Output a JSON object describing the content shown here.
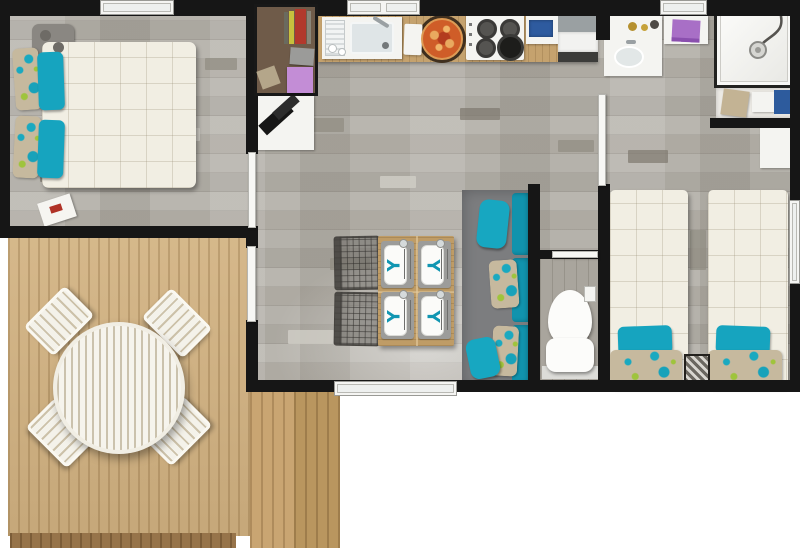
{
  "scene": {
    "description": "Top-down 3D rendered floor plan of a two-bedroom holiday mobile home with a wooden terrace",
    "background_color": "#ffffff"
  },
  "palette": {
    "wall": "#161616",
    "interior_floor": "#b5b2ab",
    "terrace_wood": "#d2b281",
    "terrace_step": "#c9a572",
    "accent_teal": "#16a4bf",
    "bedding_white": "#f1eee3",
    "sofa_gray": "#7c7d7f",
    "counter_wood": "#c5a26e",
    "towel_purple": "#a86fc6",
    "accessory_blue": "#2d5b9d",
    "pizza_orange": "#cf5d28"
  },
  "rooms": [
    {
      "id": "master-bedroom",
      "label": "Master bedroom",
      "items": [
        "double-bed",
        "teal-pillows",
        "patterned-pillows",
        "wall-lamp",
        "magazine"
      ]
    },
    {
      "id": "entry-nook",
      "label": "Wardrobe and desk nook",
      "items": [
        "wardrobe-shelves",
        "books",
        "gray-box",
        "purple-box",
        "desk",
        "laptop"
      ]
    },
    {
      "id": "kitchen",
      "label": "Kitchen",
      "items": [
        "counter",
        "sink",
        "dish-drainer",
        "cutting-board",
        "pizza",
        "gas-hob",
        "towel-unit",
        "appliance"
      ]
    },
    {
      "id": "bathroom",
      "label": "Bathroom",
      "items": [
        "washbasin",
        "towel-shelf",
        "shower",
        "bench-with-towels"
      ]
    },
    {
      "id": "living-dining",
      "label": "Living / dining room",
      "items": [
        "dining-table",
        "four-place-settings",
        "two-mesh-chairs",
        "sofa",
        "teal-cushions",
        "patterned-cushions"
      ]
    },
    {
      "id": "wc",
      "label": "WC",
      "items": [
        "toilet",
        "toilet-roll-holder"
      ]
    },
    {
      "id": "twin-bedroom",
      "label": "Twin bedroom",
      "items": [
        "single-bed-left",
        "single-bed-right",
        "teal-pillows",
        "patterned-pillows",
        "storage-box",
        "white-dresser"
      ]
    },
    {
      "id": "terrace",
      "label": "Terrace",
      "items": [
        "round-garden-table",
        "four-garden-chairs",
        "steps"
      ]
    }
  ],
  "openings": {
    "windows": [
      "master-bedroom-top",
      "kitchen-top",
      "bathroom-top",
      "living-room-bottom",
      "twin-bedroom-right"
    ],
    "doors": [
      "terrace-entrance",
      "master-bedroom-door",
      "twin-bedroom-door",
      "wc-doorway"
    ]
  },
  "napkin_glyph": "Y"
}
